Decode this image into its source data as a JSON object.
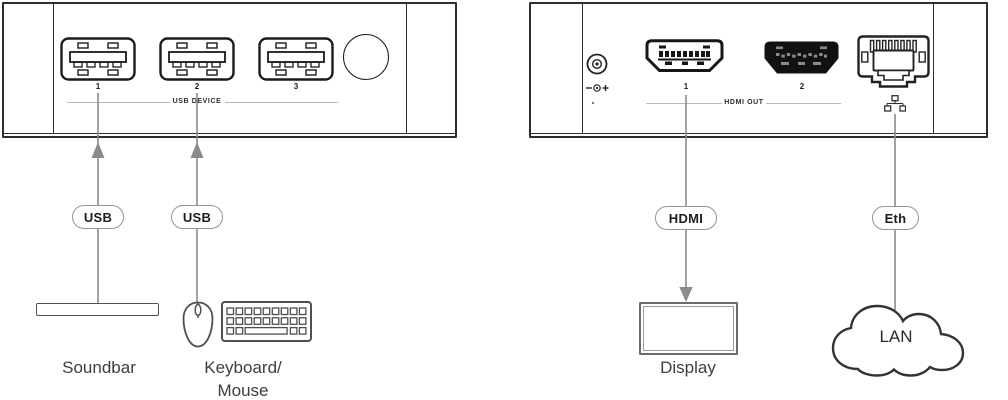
{
  "front_panel": {
    "group_label": "USB DEVICE",
    "port_numbers": [
      "1",
      "2",
      "3"
    ]
  },
  "rear_panel": {
    "group_label": "HDMI OUT",
    "port_numbers": [
      "1",
      "2"
    ]
  },
  "tags": {
    "usb1": "USB",
    "usb2": "USB",
    "hdmi": "HDMI",
    "eth": "Eth"
  },
  "devices": {
    "soundbar": "Soundbar",
    "keyboard_mouse": "Keyboard/\nMouse",
    "display": "Display",
    "lan": "LAN"
  },
  "icons": {
    "usb_port": "usb-a-port",
    "panel_button": "round-button",
    "dc_power": "dc-power-connector",
    "polarity": "center-positive-polarity",
    "hdmi_port": "hdmi-port",
    "ethernet_port": "rj45-port",
    "lan_small": "lan-network-icon"
  },
  "colors": {
    "panel_border": "#2e2e2e",
    "connector_line": "#8b8b8b",
    "flank_line": "#b9b9b9",
    "label_text": "#3e3e3e",
    "port_fill_dark": "#111111"
  }
}
